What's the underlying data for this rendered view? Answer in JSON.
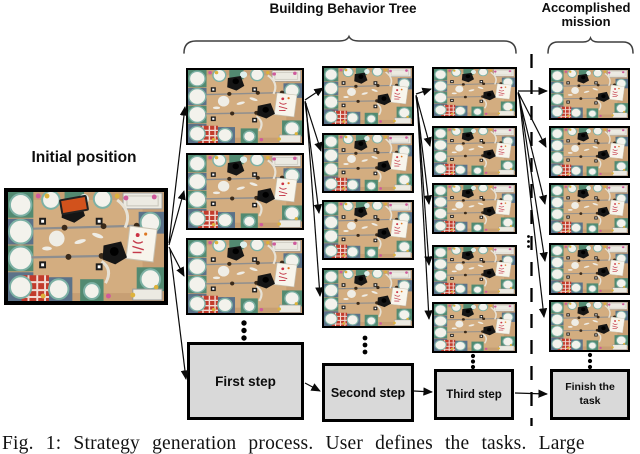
{
  "header": {
    "building_label": "Building Behavior Tree",
    "accomplished_label": "Accomplished mission"
  },
  "initial_position": {
    "label": "Initial position"
  },
  "tree": {
    "columns": [
      {
        "step_label": "First step",
        "thumbnail_count": 3
      },
      {
        "step_label": "Second step",
        "thumbnail_count": 4
      },
      {
        "step_label": "Third step",
        "thumbnail_count": 5
      },
      {
        "step_label": "Finish the task",
        "thumbnail_count": 5
      }
    ],
    "continuation_marker": "vertical-ellipsis"
  },
  "caption": "Fig. 1: Strategy generation process. User defines the tasks. Large",
  "colors": {
    "step_box_fill": "#d9d9d9",
    "edge_color": "#0a0a0a",
    "table_wood": "#c79f74",
    "placemat_blue": "#5b7289",
    "placemat_green": "#528a71",
    "cloth_red": "#c23b2c"
  }
}
